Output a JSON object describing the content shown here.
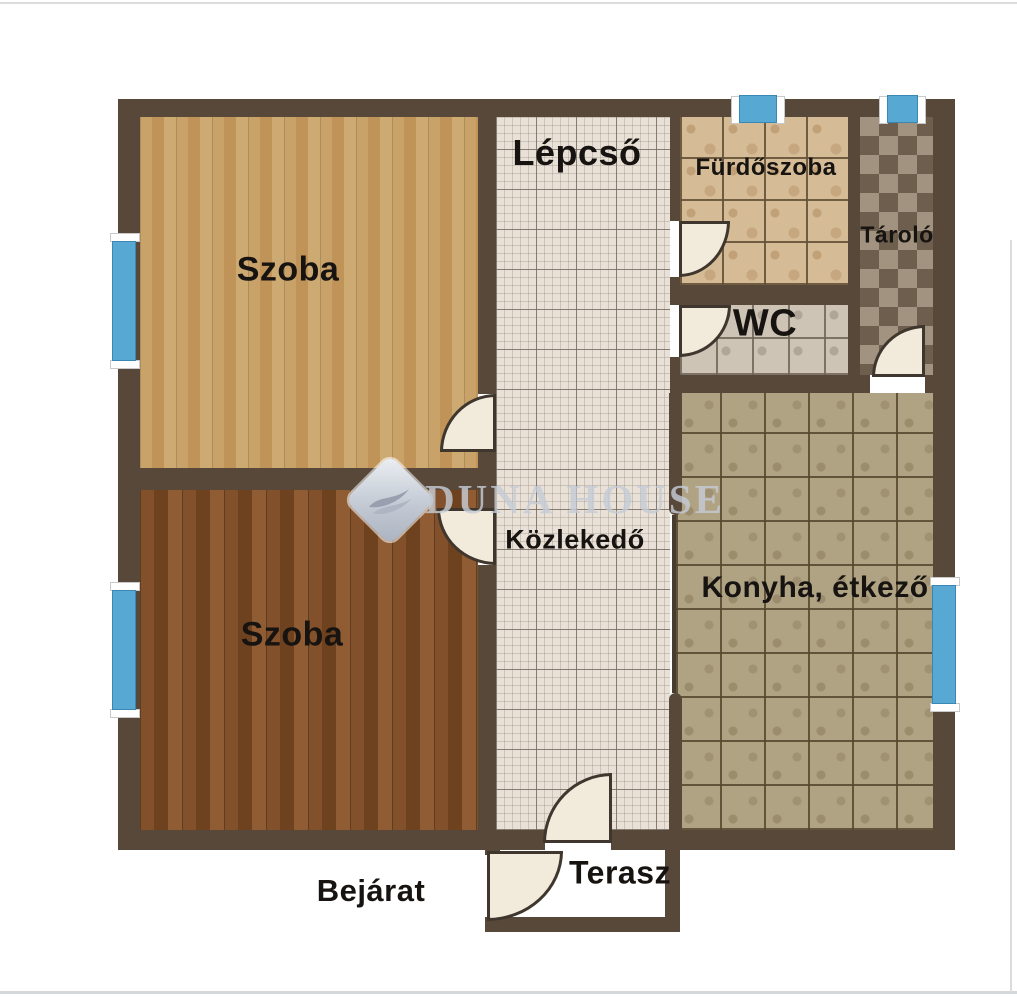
{
  "watermark": {
    "text": "Duna House",
    "logo_icon": "duna-house-logo"
  },
  "rooms": {
    "szoba_top": {
      "label": "Szoba"
    },
    "szoba_bottom": {
      "label": "Szoba"
    },
    "lepcso": {
      "label": "Lépcső"
    },
    "kozlekedo": {
      "label": "Közlekedő"
    },
    "furdoszoba": {
      "label": "Fürdőszoba"
    },
    "tarolo": {
      "label": "Tároló"
    },
    "wc": {
      "label": "WC"
    },
    "konyha": {
      "label": "Konyha, étkező"
    },
    "terasz": {
      "label": "Terasz"
    },
    "bejarat": {
      "label": "Bejárat"
    }
  },
  "colors": {
    "wall": "#584839",
    "window_glass": "#57a8d3",
    "door_leaf": "#f2ebdc",
    "label_text": "#161310",
    "hall_tile": "#e9e1d7",
    "bathroom_tile": "#d5bc96",
    "wc_tile": "#cdc4b6",
    "storage_tile_dark": "#6d5e4e",
    "storage_tile_light": "#a29380",
    "kitchen_tile": "#b0a384",
    "wood_light": "#c5a066",
    "wood_dark": "#7d4e2a"
  }
}
